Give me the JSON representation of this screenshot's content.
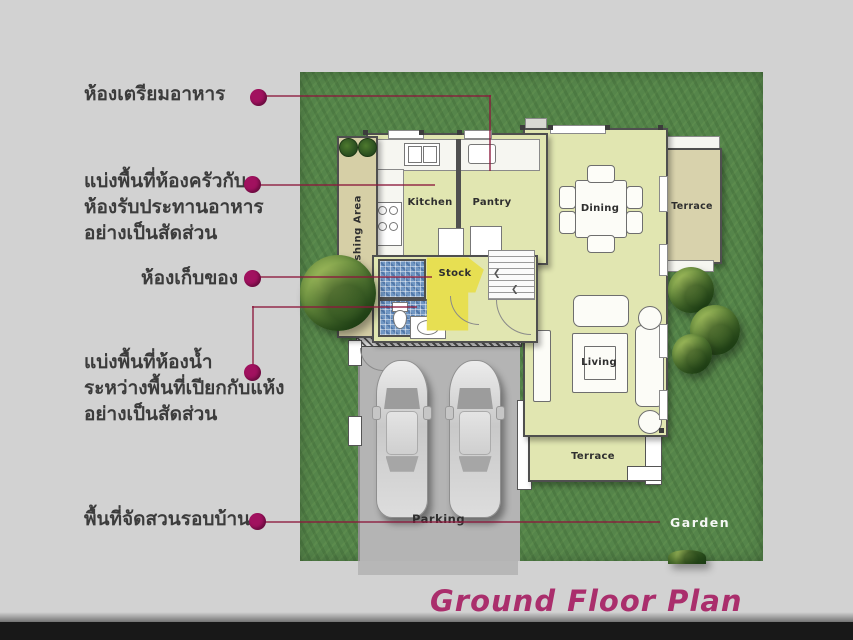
{
  "page": {
    "title": "Ground Floor Plan",
    "background_color": "#d2d2d2",
    "accent_dot_color": "#a1115f",
    "annotation_line_color": "#8c193c",
    "title_color": "#aa2e6c"
  },
  "annotations": [
    {
      "lines": [
        "ห้องเตรียมอาหาร"
      ]
    },
    {
      "lines": [
        "แบ่งพื้นที่ห้องครัวกับ",
        "ห้องรับประทานอาหาร",
        "อย่างเป็นสัดส่วน"
      ]
    },
    {
      "lines": [
        "ห้องเก็บของ"
      ]
    },
    {
      "lines": [
        "แบ่งพื้นที่ห้องน้ำ",
        "ระหว่างพื้นที่เปียกกับแห้ง",
        "อย่างเป็นสัดส่วน"
      ]
    },
    {
      "lines": [
        "พื้นที่จัดสวนรอบบ้าน"
      ]
    }
  ],
  "plan": {
    "room_labels": {
      "washing_area": "Washing Area",
      "kitchen": "Kitchen",
      "pantry": "Pantry",
      "dining": "Dining",
      "terrace_right": "Terrace",
      "stock": "Stock",
      "living": "Living",
      "terrace_bottom": "Terrace",
      "parking": "Parking",
      "garden": "Garden"
    },
    "colors": {
      "grass": "#55854a",
      "room_floor": "#e1e6b1",
      "terrace_floor": "#d8d2ac",
      "stock_floor": "#e7df52",
      "wet_tile": "#7096c2",
      "driveway": "#b4b4b4"
    }
  }
}
